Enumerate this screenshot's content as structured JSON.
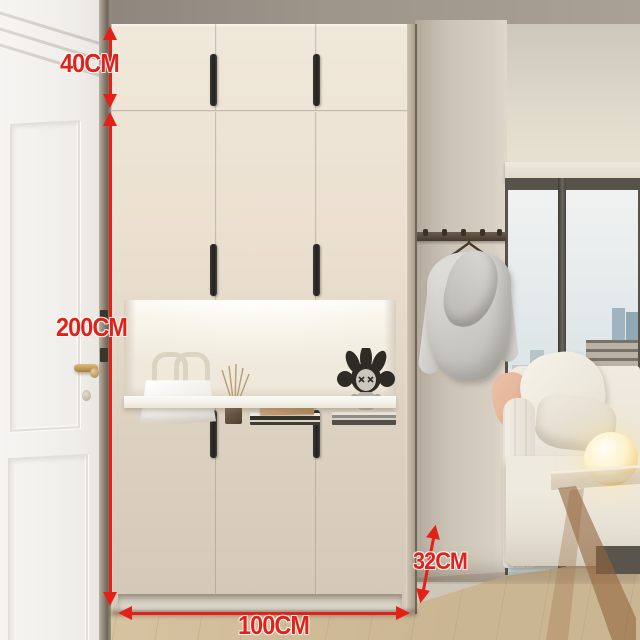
{
  "annotations": {
    "top_cabinet_height": "40CM",
    "total_height": "200CM",
    "depth": "32CM",
    "width": "100CM"
  },
  "palette": {
    "accent": "#e32119",
    "cabinet_light": "#eadfcf",
    "cabinet_dark": "#d3c8b8",
    "handle": "#23211e",
    "wall": "#cfc6ba",
    "floor": "#dcc8a6",
    "sky_top": "#f0f2f1",
    "sky_bottom": "#c7d3d8",
    "sofa": "#e8e3d8",
    "robe": "#ceccc7",
    "rack": "#6a5d4e",
    "lamp": "#f0d084",
    "niche": "#f8f4ea"
  },
  "objects": [
    "white-panel-door",
    "entry-cabinet",
    "display-niche",
    "handbag",
    "reed-diffuser",
    "book-stack",
    "decor-box",
    "art-toy-figure",
    "coat-rack",
    "bathrobe",
    "city-window",
    "sofa",
    "globe-lamp",
    "acrylic-side-table",
    "wood-floor"
  ]
}
